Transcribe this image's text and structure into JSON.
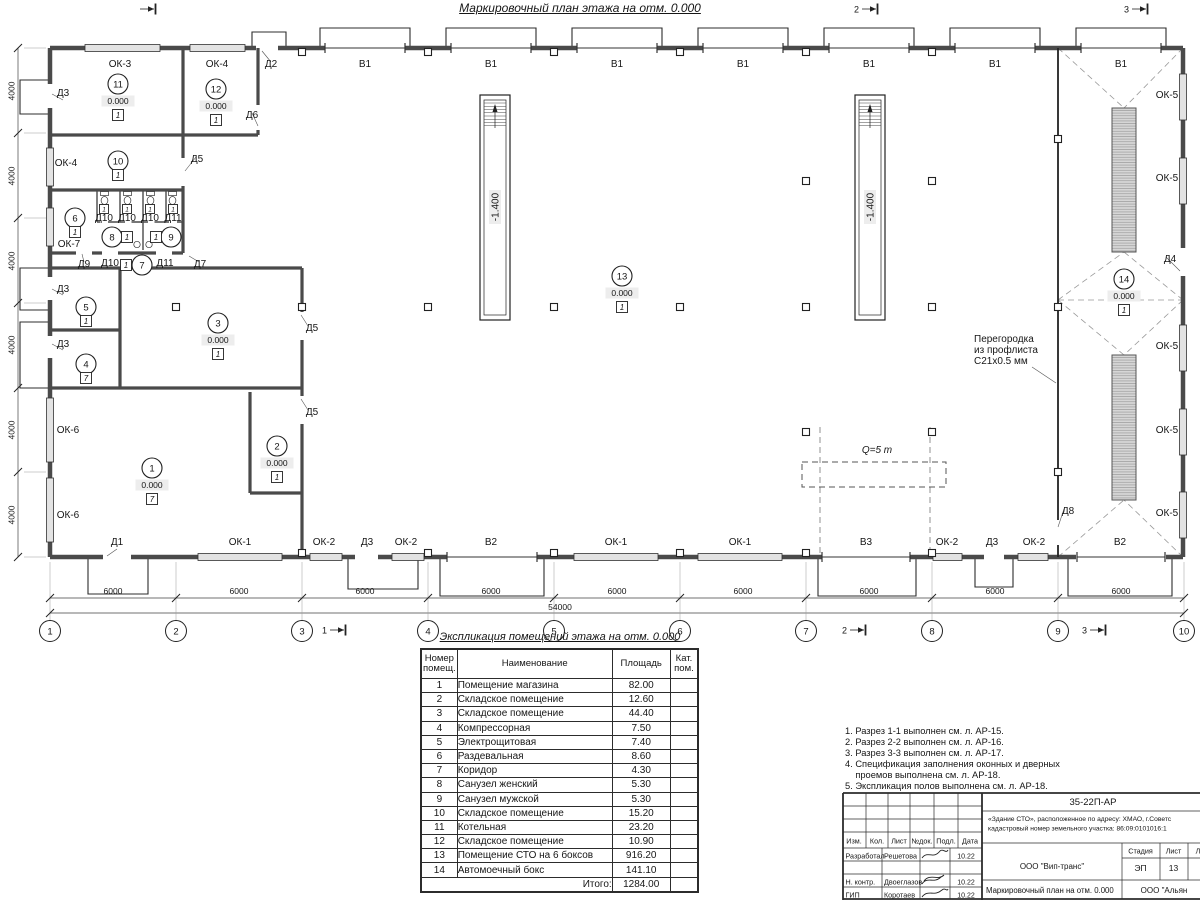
{
  "drawing_title": "Маркировочный план этажа на отм. 0.000",
  "expl_table": {
    "title": "Экспликация помещений этажа на отм. 0.000",
    "headers": [
      "Номер помещ.",
      "Наименование",
      "Площадь",
      "Кат. пом."
    ],
    "rows": [
      [
        "1",
        "Помещение магазина",
        "82.00",
        ""
      ],
      [
        "2",
        "Складское помещение",
        "12.60",
        ""
      ],
      [
        "3",
        "Складское помещение",
        "44.40",
        ""
      ],
      [
        "4",
        "Компрессорная",
        "7.50",
        ""
      ],
      [
        "5",
        "Электрощитовая",
        "7.40",
        ""
      ],
      [
        "6",
        "Раздевальная",
        "8.60",
        ""
      ],
      [
        "7",
        "Коридор",
        "4.30",
        ""
      ],
      [
        "8",
        "Санузел женский",
        "5.30",
        ""
      ],
      [
        "9",
        "Санузел мужской",
        "5.30",
        ""
      ],
      [
        "10",
        "Складское помещение",
        "15.20",
        ""
      ],
      [
        "11",
        "Котельная",
        "23.20",
        ""
      ],
      [
        "12",
        "Складское помещение",
        "10.90",
        ""
      ],
      [
        "13",
        "Помещение СТО на 6 боксов",
        "916.20",
        ""
      ],
      [
        "14",
        "Автомоечный бокс",
        "141.10",
        ""
      ]
    ],
    "total_label": "Итого:",
    "total_value": "1284.00"
  },
  "notes": [
    "1. Разрез 1-1 выполнен см. л. АР-15.",
    "2. Разрез 2-2 выполнен см. л. АР-16.",
    "3. Разрез 3-3 выполнен см. л. АР-17.",
    "4. Спецификация заполнения оконных и дверных",
    "    проемов выполнена см. л. АР-18.",
    "5. Экспликация полов выполнена см. л. АР-18."
  ],
  "title_block": {
    "doc_number": "35-22П-АР",
    "object_line1": "«Здание СТО», расположенное по адресу: ХМАО, г.Советс",
    "object_line2": "кадастровый номер земельного участка: 86:09:0101016:1",
    "change_headers": [
      "Изм.",
      "Кол.",
      "Лист",
      "№док.",
      "Подл.",
      "Дата"
    ],
    "roles": [
      {
        "role": "Разработал",
        "name": "Решетова",
        "date": "10.22"
      },
      {
        "role": "Н. контр.",
        "name": "Двоеглазов",
        "date": "10.22"
      },
      {
        "role": "ГИП",
        "name": "Коротаев",
        "date": "10.22"
      }
    ],
    "company": "ООО \"Вип-транс\"",
    "stage_label": "Стадия",
    "sheet_label": "Лист",
    "sheets_label": "Л",
    "stage": "ЭП",
    "sheet_no": "13",
    "plan_name": "Маркировочный план на отм. 0.000",
    "company2": "ООО \"Альян"
  },
  "plan": {
    "elev_value": "0.000",
    "partition_note": [
      "Перегородка",
      "из профлиста",
      "С21х0.5 мм"
    ],
    "crane_label": "Q=5 т",
    "pit_label": "-1.400",
    "labels": [
      [
        "ОК-3",
        120,
        67,
        ""
      ],
      [
        "ОК-4",
        217,
        67,
        ""
      ],
      [
        "Д2",
        271,
        67,
        ""
      ],
      [
        "В1",
        365,
        67,
        ""
      ],
      [
        "В1",
        491,
        67,
        ""
      ],
      [
        "В1",
        617,
        67,
        ""
      ],
      [
        "В1",
        743,
        67,
        ""
      ],
      [
        "В1",
        869,
        67,
        ""
      ],
      [
        "В1",
        995,
        67,
        ""
      ],
      [
        "В1",
        1121,
        67,
        ""
      ],
      [
        "Д3",
        63,
        96,
        ""
      ],
      [
        "ОК-4",
        66,
        166,
        ""
      ],
      [
        "ОК-7",
        69,
        247,
        ""
      ],
      [
        "Д3",
        63,
        292,
        ""
      ],
      [
        "Д3",
        63,
        347,
        ""
      ],
      [
        "ОК-6",
        68,
        433,
        ""
      ],
      [
        "ОК-6",
        68,
        518,
        ""
      ],
      [
        "Д6",
        252,
        118,
        ""
      ],
      [
        "Д5",
        197,
        162,
        ""
      ],
      [
        "Д10",
        104,
        221,
        ""
      ],
      [
        "Д10",
        127,
        221,
        ""
      ],
      [
        "Д10",
        150,
        221,
        ""
      ],
      [
        "Д11",
        173,
        221,
        ""
      ],
      [
        "Д9",
        84,
        267,
        ""
      ],
      [
        "Д10",
        110,
        266,
        ""
      ],
      [
        "Д11",
        165,
        266,
        ""
      ],
      [
        "Д7",
        200,
        267,
        ""
      ],
      [
        "Д5",
        312,
        331,
        ""
      ],
      [
        "Д5",
        312,
        415,
        ""
      ],
      [
        "Д8",
        1068,
        514,
        ""
      ],
      [
        "Д4",
        1170,
        262,
        ""
      ],
      [
        "ОК-5",
        1167,
        98,
        ""
      ],
      [
        "ОК-5",
        1167,
        181,
        ""
      ],
      [
        "ОК-5",
        1167,
        349,
        ""
      ],
      [
        "ОК-5",
        1167,
        433,
        ""
      ],
      [
        "ОК-5",
        1167,
        516,
        ""
      ],
      [
        "Д1",
        117,
        545,
        ""
      ],
      [
        "ОК-1",
        240,
        545,
        ""
      ],
      [
        "ОК-2",
        324,
        545,
        ""
      ],
      [
        "Д3",
        367,
        545,
        ""
      ],
      [
        "ОК-2",
        406,
        545,
        ""
      ],
      [
        "В2",
        491,
        545,
        ""
      ],
      [
        "ОК-1",
        616,
        545,
        ""
      ],
      [
        "ОК-1",
        740,
        545,
        ""
      ],
      [
        "В3",
        866,
        545,
        ""
      ],
      [
        "ОК-2",
        947,
        545,
        ""
      ],
      [
        "Д3",
        992,
        545,
        ""
      ],
      [
        "ОК-2",
        1034,
        545,
        ""
      ],
      [
        "В2",
        1120,
        545,
        ""
      ],
      [
        "-1.400",
        495,
        207,
        "rb"
      ],
      [
        "-1.400",
        870,
        207,
        "rb"
      ],
      [
        "Q=5 т",
        877,
        453,
        "i"
      ],
      [
        "Перегородка",
        974,
        342,
        "l"
      ],
      [
        "из профлиста",
        974,
        353,
        "l"
      ],
      [
        "С21х0.5 мм",
        974,
        364,
        "l"
      ],
      [
        "6000",
        113,
        594,
        "d"
      ],
      [
        "6000",
        239,
        594,
        "d"
      ],
      [
        "6000",
        365,
        594,
        "d"
      ],
      [
        "6000",
        491,
        594,
        "d"
      ],
      [
        "6000",
        617,
        594,
        "d"
      ],
      [
        "6000",
        743,
        594,
        "d"
      ],
      [
        "6000",
        869,
        594,
        "d"
      ],
      [
        "6000",
        995,
        594,
        "d"
      ],
      [
        "6000",
        1121,
        594,
        "d"
      ],
      [
        "54000",
        560,
        610,
        "d"
      ],
      [
        "4000",
        11,
        91,
        "rd"
      ],
      [
        "4000",
        11,
        176,
        "rd"
      ],
      [
        "4000",
        11,
        261,
        "rd"
      ],
      [
        "4000",
        11,
        345,
        "rd"
      ],
      [
        "4000",
        11,
        430,
        "rd"
      ],
      [
        "4000",
        11,
        515,
        "rd"
      ]
    ],
    "rooms": [
      {
        "n": "1",
        "x": 152,
        "y": 468,
        "e": 1,
        "f": "7"
      },
      {
        "n": "2",
        "x": 277,
        "y": 446,
        "e": 1,
        "f": "1"
      },
      {
        "n": "3",
        "x": 218,
        "y": 323,
        "e": 1,
        "f": "1"
      },
      {
        "n": "4",
        "x": 86,
        "y": 364,
        "f": "7"
      },
      {
        "n": "5",
        "x": 86,
        "y": 307,
        "f": "1"
      },
      {
        "n": "6",
        "x": 75,
        "y": 218,
        "f": "1"
      },
      {
        "n": "7",
        "x": 142,
        "y": 265,
        "f": "1",
        "fx": 126,
        "fy": 265
      },
      {
        "n": "8",
        "x": 112,
        "y": 237,
        "f": "1",
        "fx": 127,
        "fy": 237
      },
      {
        "n": "9",
        "x": 171,
        "y": 237,
        "f": "1",
        "fx": 156,
        "fy": 237
      },
      {
        "n": "10",
        "x": 118,
        "y": 161,
        "f": "1"
      },
      {
        "n": "11",
        "x": 118,
        "y": 84,
        "e": 1,
        "f": "1"
      },
      {
        "n": "12",
        "x": 216,
        "y": 89,
        "e": 1,
        "f": "1"
      },
      {
        "n": "13",
        "x": 622,
        "y": 276,
        "e": 1,
        "f": "1"
      },
      {
        "n": "14",
        "x": 1124,
        "y": 279,
        "e": 1,
        "f": "1"
      },
      {
        "f": "1",
        "fx": 104,
        "fy": 209,
        "s": 9
      },
      {
        "f": "1",
        "fx": 127,
        "fy": 209,
        "s": 9
      },
      {
        "f": "1",
        "fx": 150,
        "fy": 209,
        "s": 9
      },
      {
        "f": "1",
        "fx": 173,
        "fy": 209,
        "s": 9
      }
    ],
    "axes": {
      "y": 631,
      "items": [
        [
          "1",
          50
        ],
        [
          "2",
          176
        ],
        [
          "3",
          302
        ],
        [
          "4",
          428
        ],
        [
          "5",
          554
        ],
        [
          "6",
          680
        ],
        [
          "7",
          806
        ],
        [
          "8",
          932
        ],
        [
          "9",
          1058
        ],
        [
          "10",
          1184
        ]
      ]
    },
    "sections": [
      {
        "n": "1",
        "x": 330,
        "y": 630
      },
      {
        "n": "2",
        "x": 850,
        "y": 630
      },
      {
        "n": "3",
        "x": 1090,
        "y": 630
      },
      {
        "n": "",
        "x": 140,
        "y": 9
      },
      {
        "n": "2",
        "x": 862,
        "y": 9
      },
      {
        "n": "3",
        "x": 1132,
        "y": 9
      }
    ]
  }
}
